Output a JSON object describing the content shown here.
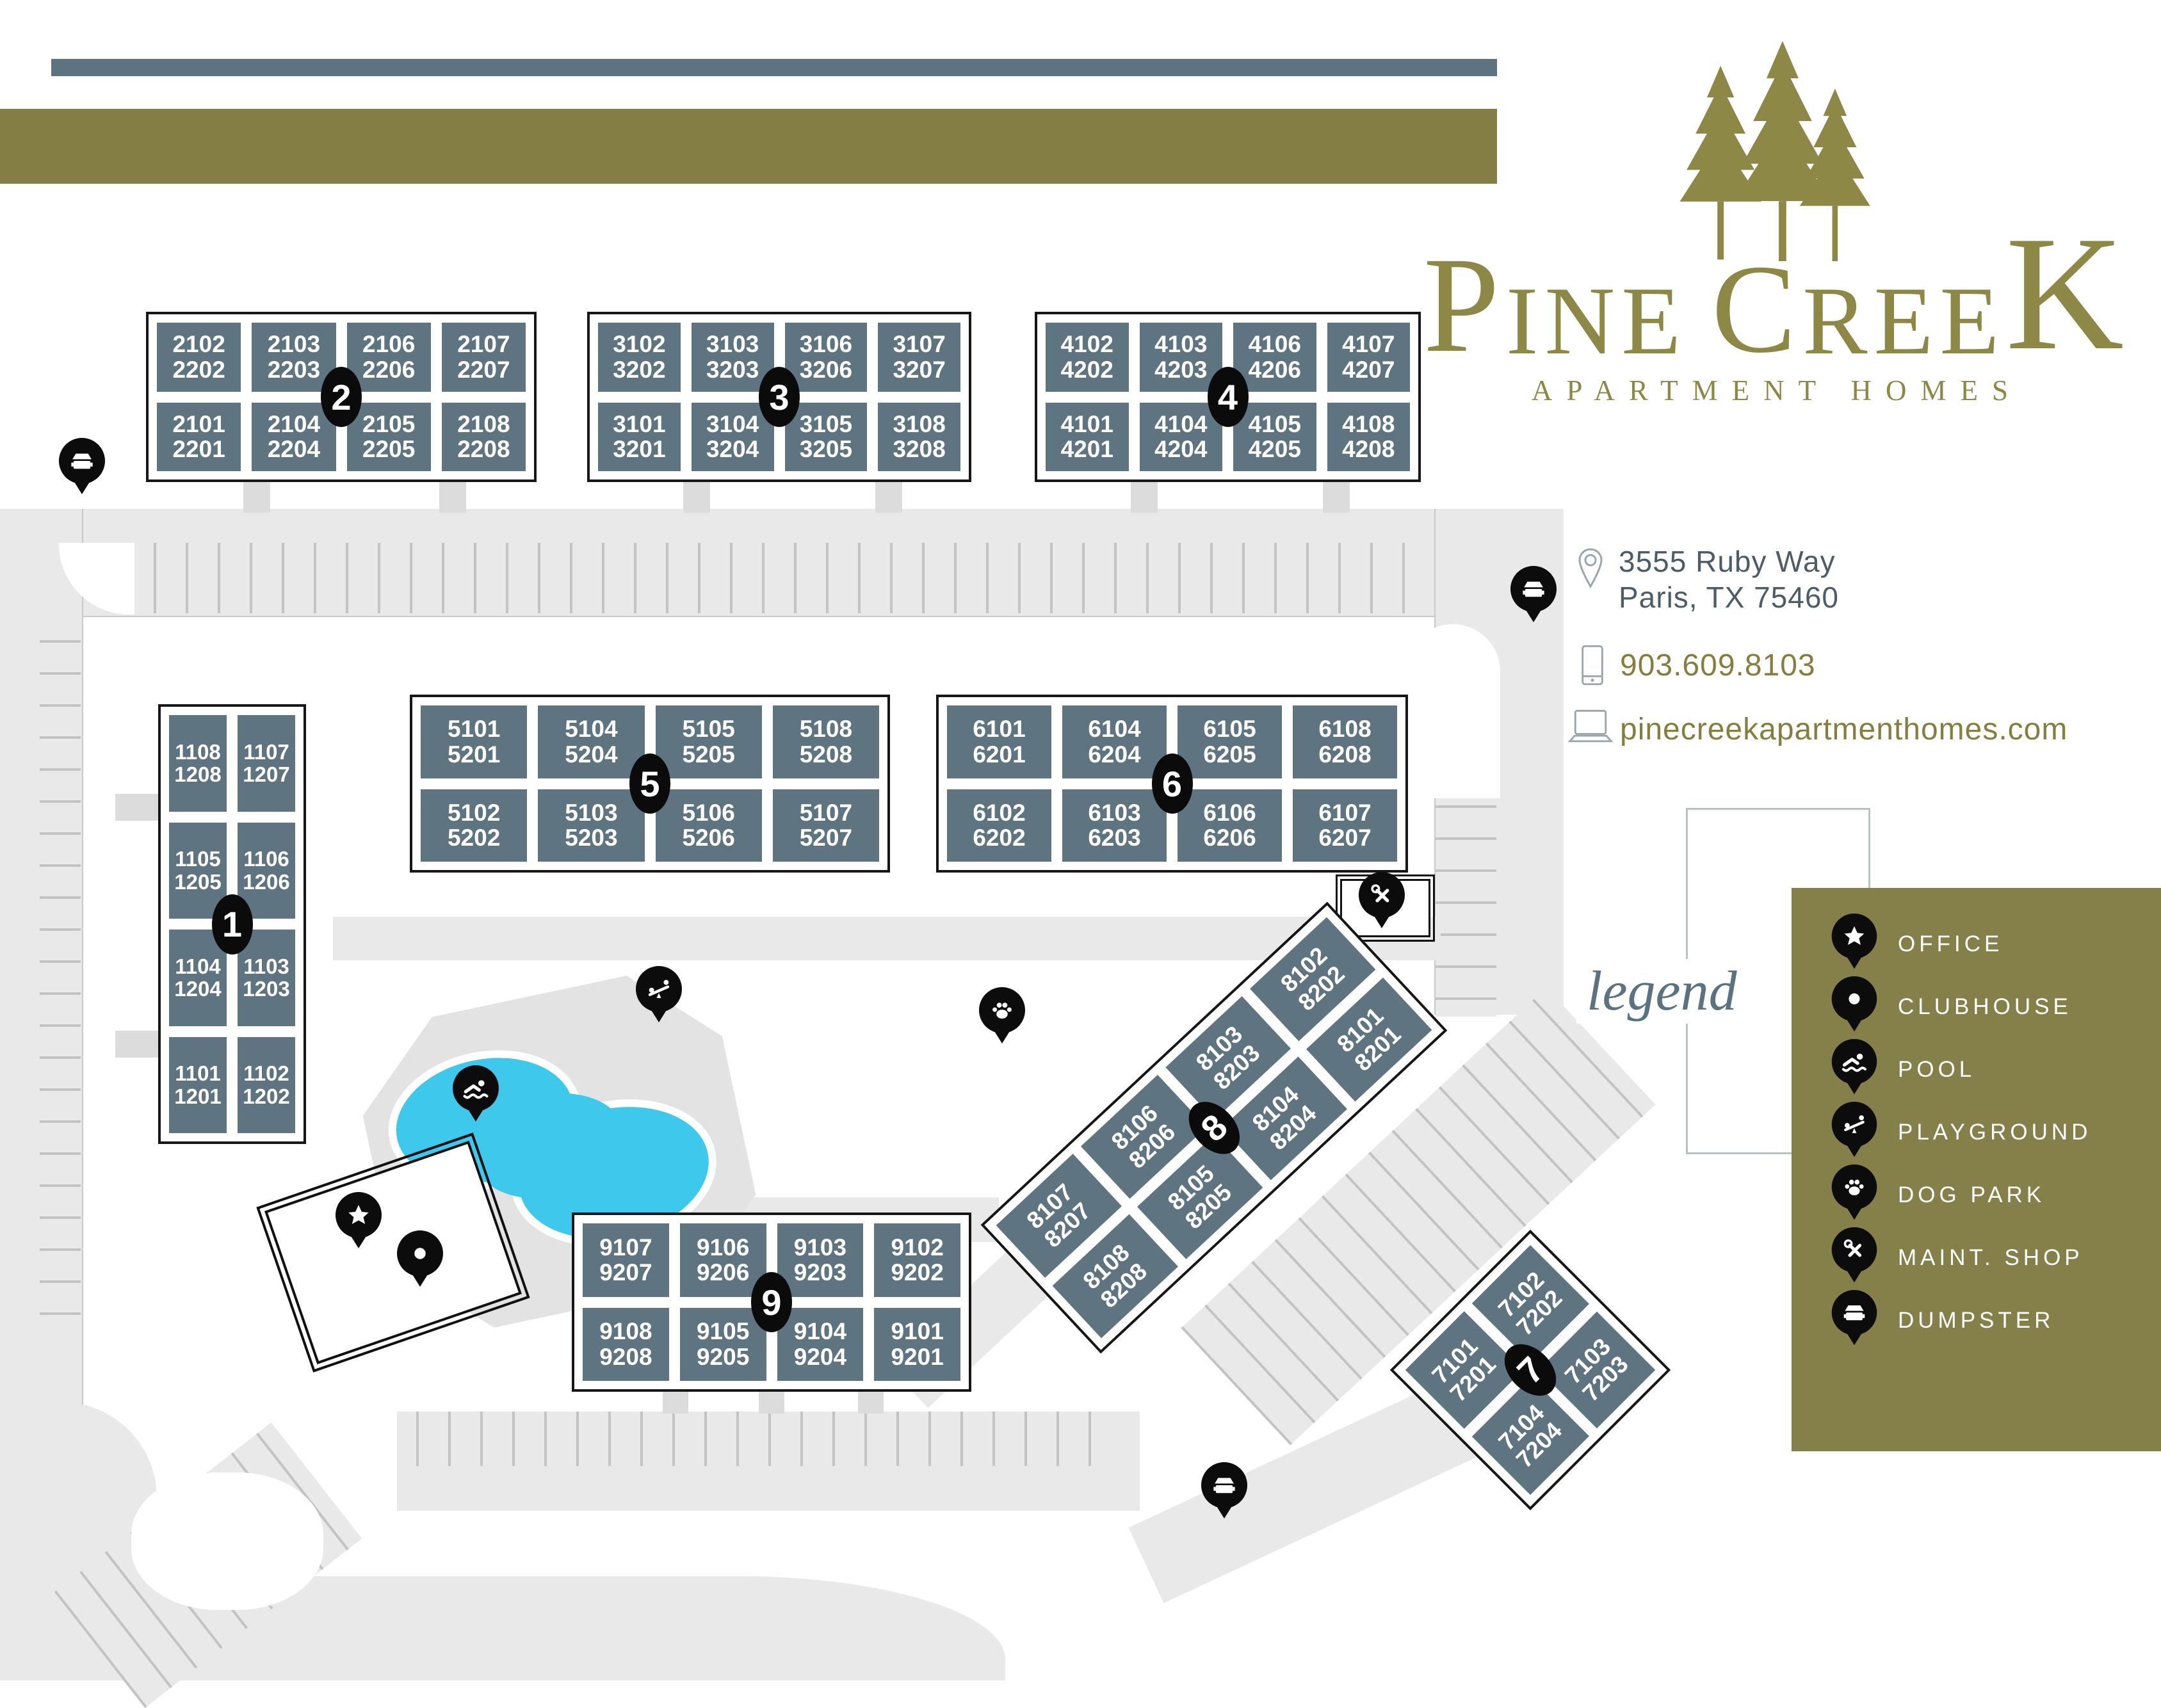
{
  "logo": {
    "part1": "P",
    "part2": "INE",
    "part3": "C",
    "part4": "REE",
    "part5": "K",
    "subtitle": "APARTMENT HOMES"
  },
  "contact": {
    "address_line1": "3555 Ruby Way",
    "address_line2": "Paris, TX 75460",
    "phone": "903.609.8103",
    "website": "pinecreekapartmenthomes.com"
  },
  "legend": {
    "title": "legend",
    "items": [
      {
        "icon": "star",
        "label": "OFFICE"
      },
      {
        "icon": "dot",
        "label": "CLUBHOUSE"
      },
      {
        "icon": "swimmer",
        "label": "POOL"
      },
      {
        "icon": "seesaw",
        "label": "PLAYGROUND"
      },
      {
        "icon": "paw",
        "label": "DOG PARK"
      },
      {
        "icon": "tools",
        "label": "MAINT. SHOP"
      },
      {
        "icon": "dumpster",
        "label": "DUMPSTER"
      }
    ]
  },
  "colors": {
    "olive": "#847e45",
    "slate_bar": "#5e7380",
    "building": "#5e7480",
    "pool": "#3ec9ec",
    "road": "#e9e9e9",
    "logo_olive": "#8d8846",
    "address_text": "#4d5c66",
    "legend_script": "#5b7381"
  },
  "buildings": {
    "b1": {
      "badge": "1",
      "cells": [
        "1108\n1208",
        "1107\n1207",
        "1105\n1205",
        "1106\n1206",
        "1104\n1204",
        "1103\n1203",
        "1101\n1201",
        "1102\n1202"
      ]
    },
    "b2": {
      "badge": "2",
      "cells": [
        "2102\n2202",
        "2103\n2203",
        "2106\n2206",
        "2107\n2207",
        "2101\n2201",
        "2104\n2204",
        "2105\n2205",
        "2108\n2208"
      ]
    },
    "b3": {
      "badge": "3",
      "cells": [
        "3102\n3202",
        "3103\n3203",
        "3106\n3206",
        "3107\n3207",
        "3101\n3201",
        "3104\n3204",
        "3105\n3205",
        "3108\n3208"
      ]
    },
    "b4": {
      "badge": "4",
      "cells": [
        "4102\n4202",
        "4103\n4203",
        "4106\n4206",
        "4107\n4207",
        "4101\n4201",
        "4104\n4204",
        "4105\n4205",
        "4108\n4208"
      ]
    },
    "b5": {
      "badge": "5",
      "cells": [
        "5101\n5201",
        "5104\n5204",
        "5105\n5205",
        "5108\n5208",
        "5102\n5202",
        "5103\n5203",
        "5106\n5206",
        "5107\n5207"
      ]
    },
    "b6": {
      "badge": "6",
      "cells": [
        "6101\n6201",
        "6104\n6204",
        "6105\n6205",
        "6108\n6208",
        "6102\n6202",
        "6103\n6203",
        "6106\n6206",
        "6107\n6207"
      ]
    },
    "b7": {
      "badge": "7",
      "cells": [
        "7101\n7201",
        "7102\n7202",
        "7104\n7204",
        "7103\n7203"
      ]
    },
    "b8": {
      "badge": "8",
      "cells": [
        "8107\n8207",
        "8106\n8206",
        "8103\n8203",
        "8102\n8202",
        "8108\n8208",
        "8105\n8205",
        "8104\n8204",
        "8101\n8201"
      ]
    },
    "b9": {
      "badge": "9",
      "cells": [
        "9107\n9207",
        "9106\n9206",
        "9103\n9203",
        "9102\n9202",
        "9108\n9208",
        "9105\n9205",
        "9104\n9204",
        "9101\n9201"
      ]
    }
  }
}
